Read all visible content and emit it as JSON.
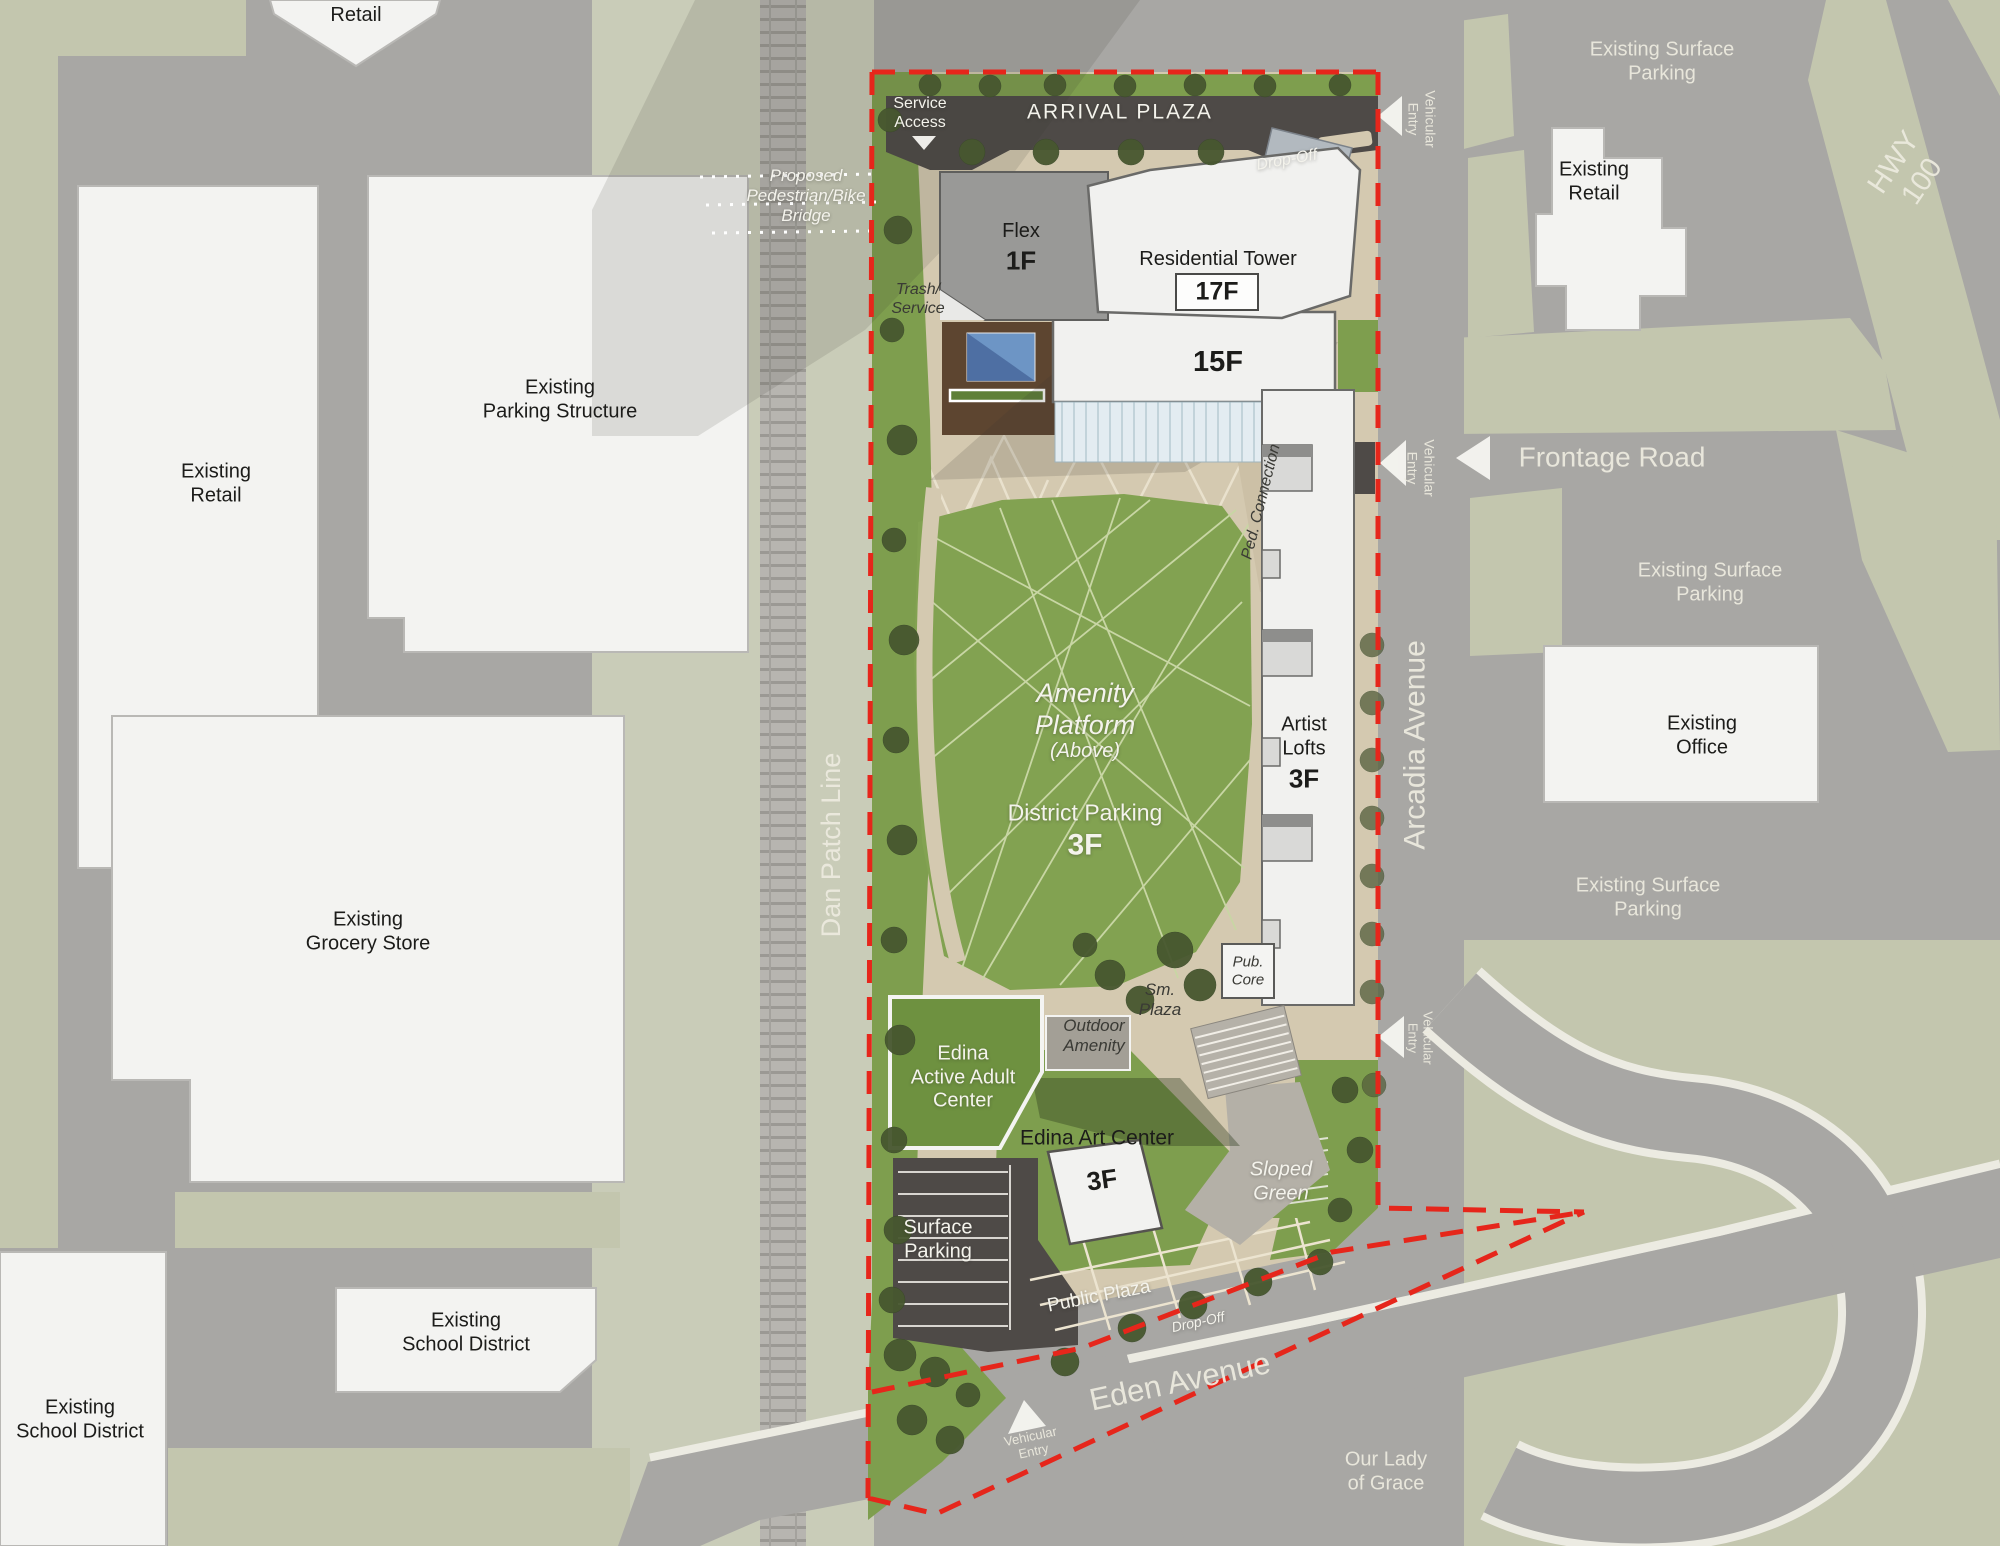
{
  "meta": {
    "title": "Development Site Plan"
  },
  "labels": {
    "retail": "Retail",
    "existing_retail": "Existing\nRetail",
    "existing_surface_parking": "Existing Surface\nParking",
    "existing_parking_structure": "Existing\nParking Structure",
    "existing_grocery_store": "Existing\nGrocery Store",
    "existing_school_district": "Existing\nSchool District",
    "existing_office": "Existing\nOffice",
    "our_lady_of_grace": "Our Lady\nof Grace",
    "hwy_100": "HWY 100",
    "frontage_road": "Frontage Road",
    "arcadia_avenue": "Arcadia Avenue",
    "eden_avenue": "Eden Avenue",
    "dan_patch_line": "Dan Patch Line",
    "proposed_bridge": "Proposed\nPedestrian/Bike\nBridge",
    "arrival_plaza": "ARRIVAL PLAZA",
    "service_access": "Service\nAccess",
    "drop_off": "Drop-Off",
    "vehicular_entry": "Vehicular\nEntry",
    "flex": "Flex",
    "flex_floors": "1F",
    "residential_tower": "Residential Tower",
    "residential_tower_floors": "17F",
    "mid_rise_floors": "15F",
    "trash_service": "Trash/\nService",
    "ped_connection": "Ped. Connection",
    "amenity_platform": "Amenity\nPlatform",
    "amenity_platform_note": "(Above)",
    "district_parking": "District Parking",
    "district_parking_floors": "3F",
    "artist_lofts": "Artist\nLofts",
    "artist_lofts_floors": "3F",
    "pub_core": "Pub.\nCore",
    "sm_plaza": "Sm.\nPlaza",
    "outdoor_amenity": "Outdoor\nAmenity",
    "edina_active_adult_center": "Edina\nActive Adult\nCenter",
    "edina_art_center": "Edina Art Center",
    "edina_art_center_floors": "3F",
    "sloped_green": "Sloped\nGreen",
    "surface_parking": "Surface\nParking",
    "public_plaza": "Public Plaza"
  },
  "colors": {
    "road_gray": "#a8a7a4",
    "landscape_sage": "#c3c6ae",
    "rail_corridor": "#c9ccb8",
    "site_tan": "#d4c9b0",
    "site_green": "#7e9e4e",
    "lawn_green": "#82a251",
    "asphalt_dark": "#4e4a47",
    "deck_brown": "#5d4530",
    "pool_blue": "#6d95c5",
    "building_white": "#f2f2f0",
    "building_gray": "#999997",
    "boundary_red": "#e6261b",
    "tree_green": "#47572f"
  }
}
